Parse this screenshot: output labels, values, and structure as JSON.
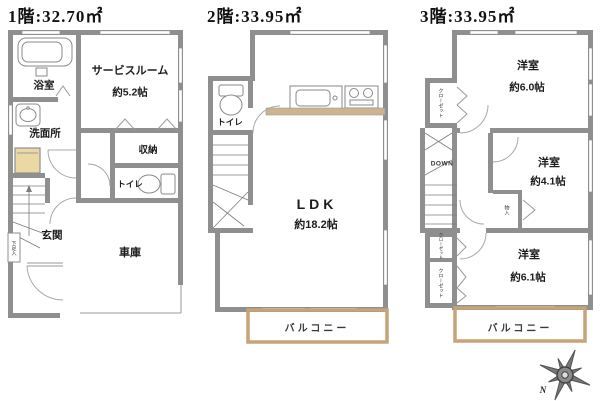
{
  "floor1": {
    "title": "1階:32.70㎡",
    "bath": "浴室",
    "service_room": "サービスルーム",
    "service_room_size": "約5.2帖",
    "washroom": "洗面所",
    "storage": "収納",
    "toilet": "トイレ",
    "entrance": "玄関",
    "garage": "車庫",
    "shoe_cabinet": "下足入"
  },
  "floor2": {
    "title": "2階:33.95㎡",
    "toilet": "トイレ",
    "ldk": "LDK",
    "ldk_size": "約18.2帖",
    "balcony": "バルコニー"
  },
  "floor3": {
    "title": "3階:33.95㎡",
    "bedroom1": "洋室",
    "bedroom1_size": "約6.0帖",
    "bedroom2": "洋室",
    "bedroom2_size": "約4.1帖",
    "bedroom3": "洋室",
    "bedroom3_size": "約6.1帖",
    "closet_top": "クローゼット",
    "closet_mid": "クローゼット",
    "closet_bottom": "クローゼット",
    "storage_small": "物入",
    "stairs_down_label": "DOWN",
    "balcony": "バルコニー"
  },
  "compass": {
    "north": "N"
  },
  "colors": {
    "wall": "#8f8f8f",
    "balcony_border": "#c7a379",
    "kitchen_counter": "#cdb48e",
    "laundry_pan": "#ead9a4"
  }
}
